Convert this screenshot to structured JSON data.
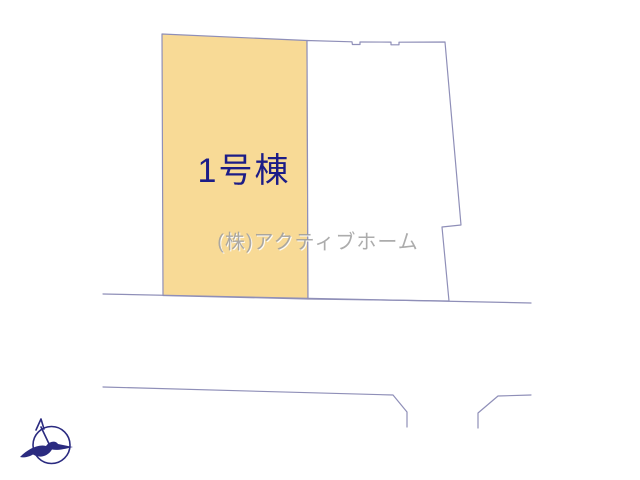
{
  "plan": {
    "lot1": {
      "label": "1号棟"
    },
    "lot2": {
      "label": ""
    },
    "watermark": "(株)アクティブホーム"
  },
  "colors": {
    "lot1_fill": "#f8da96",
    "lot2_fill": "#ffffff",
    "boundary_line": "#8f8fb8",
    "lot_label_navy": "#1c1c87",
    "watermark_gray": "#9e9e9e",
    "watermark_emboss": "#ffffff",
    "compass_navy": "#2b2b80"
  },
  "icons": {
    "compass": "north-compass-bird-icon"
  }
}
